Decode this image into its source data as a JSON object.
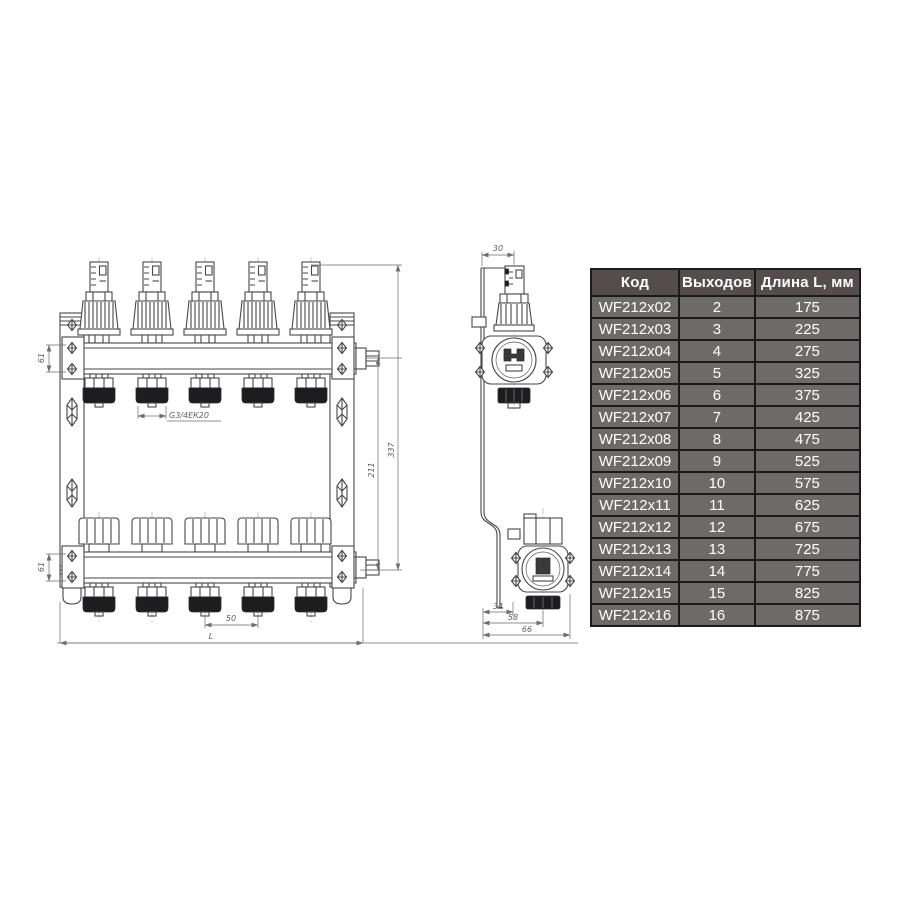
{
  "drawing": {
    "front_view": {
      "dims": {
        "d61_top": "61",
        "d61_bottom": "61",
        "thread": "G3/4ЕК20",
        "d50": "50",
        "dL": "L",
        "d211": "211",
        "d337": "337"
      }
    },
    "side_view": {
      "dims": {
        "d30": "30",
        "d34": "34",
        "d58": "58",
        "d66": "66"
      }
    }
  },
  "table": {
    "headers": [
      "Код",
      "Выходов",
      "Длина L, мм"
    ],
    "cell_names": [
      "cell-code",
      "cell-outputs",
      "cell-length"
    ],
    "rows": [
      [
        "WF212x02",
        "2",
        "175"
      ],
      [
        "WF212x03",
        "3",
        "225"
      ],
      [
        "WF212x04",
        "4",
        "275"
      ],
      [
        "WF212x05",
        "5",
        "325"
      ],
      [
        "WF212x06",
        "6",
        "375"
      ],
      [
        "WF212x07",
        "7",
        "425"
      ],
      [
        "WF212x08",
        "8",
        "475"
      ],
      [
        "WF212x09",
        "9",
        "525"
      ],
      [
        "WF212x10",
        "10",
        "575"
      ],
      [
        "WF212x11",
        "11",
        "625"
      ],
      [
        "WF212x12",
        "12",
        "675"
      ],
      [
        "WF212x13",
        "13",
        "725"
      ],
      [
        "WF212x14",
        "14",
        "775"
      ],
      [
        "WF212x15",
        "15",
        "825"
      ],
      [
        "WF212x16",
        "16",
        "875"
      ]
    ],
    "colors": {
      "header_bg": "#554d4d",
      "row_bg": "#6e6a6a",
      "border": "#1b1b1b",
      "text": "#ffffff"
    }
  }
}
